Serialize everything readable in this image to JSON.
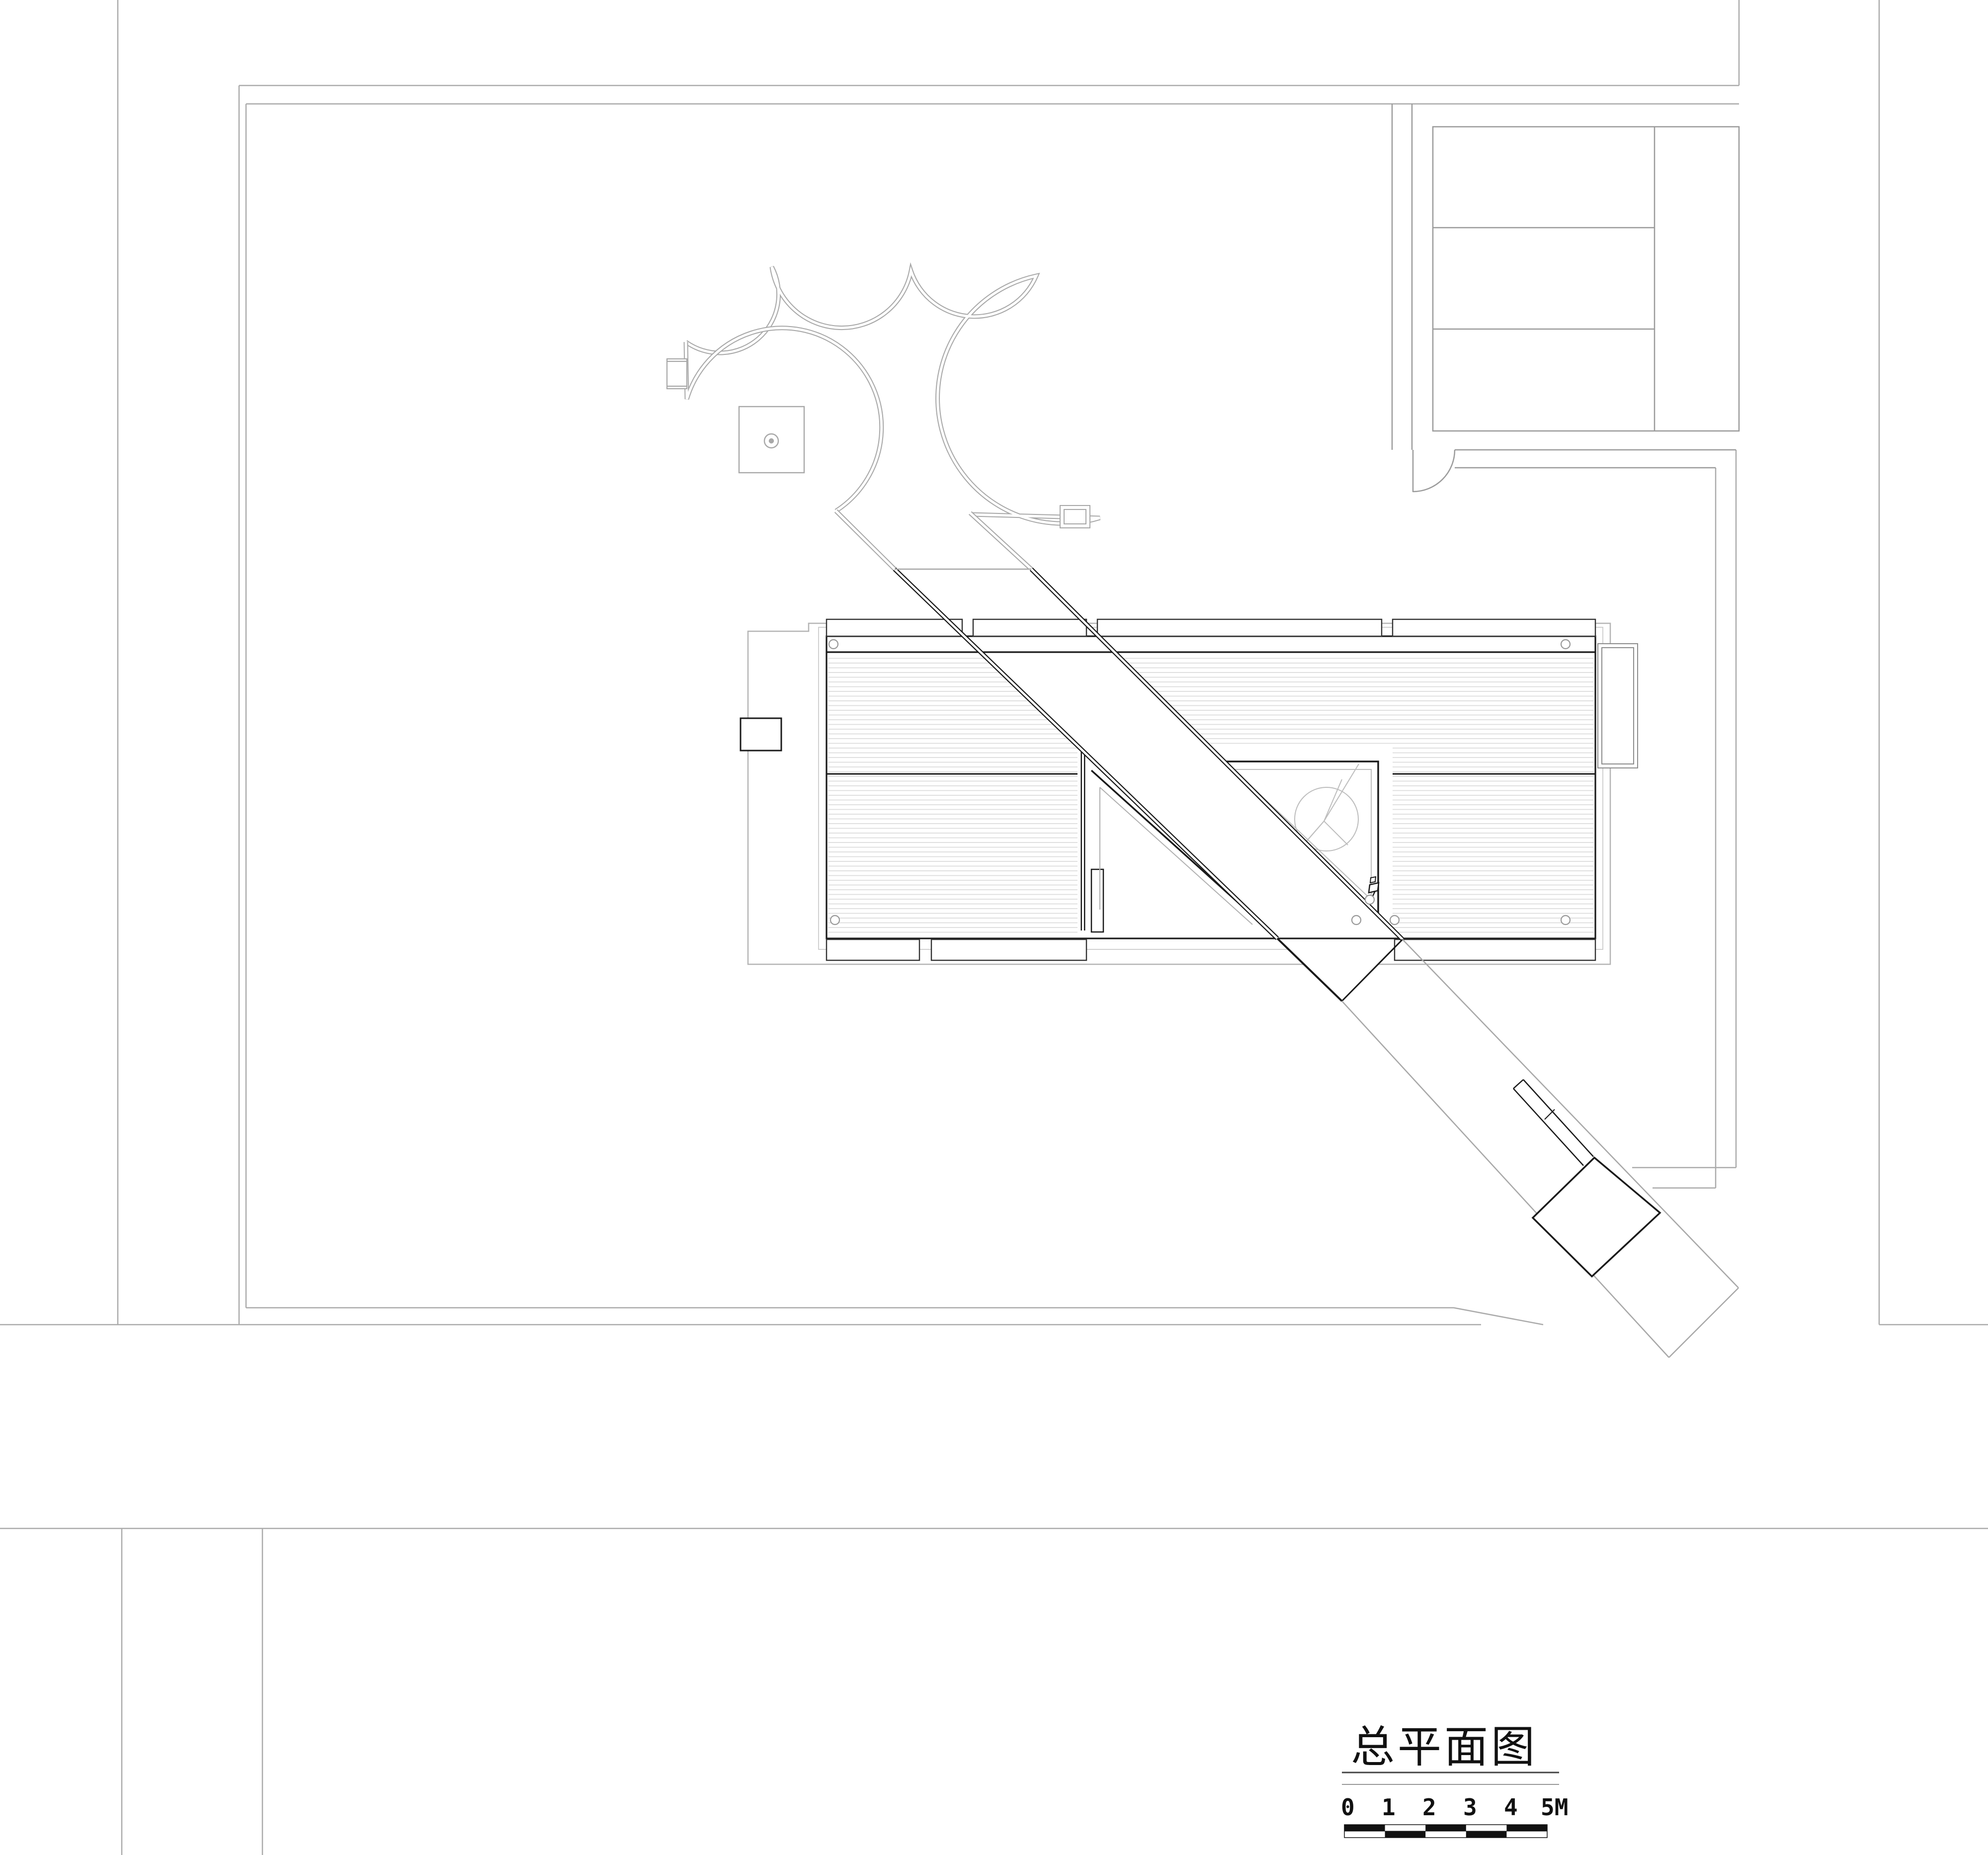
{
  "drawing": {
    "kind": "architectural site plan",
    "title": "总平面图",
    "scale_bar": {
      "labels": [
        "0",
        "1",
        "2",
        "3",
        "4",
        "5M"
      ],
      "unit": "M",
      "segments": 5,
      "segment_value": 1
    },
    "colors": {
      "background": "#ffffff",
      "heavy_line": "#1a1a1a",
      "medium_line": "#444444",
      "boundary_line": "#ababab",
      "inner_light_line": "#c9c9c9",
      "hatch_line": "#dcdcdc"
    }
  }
}
